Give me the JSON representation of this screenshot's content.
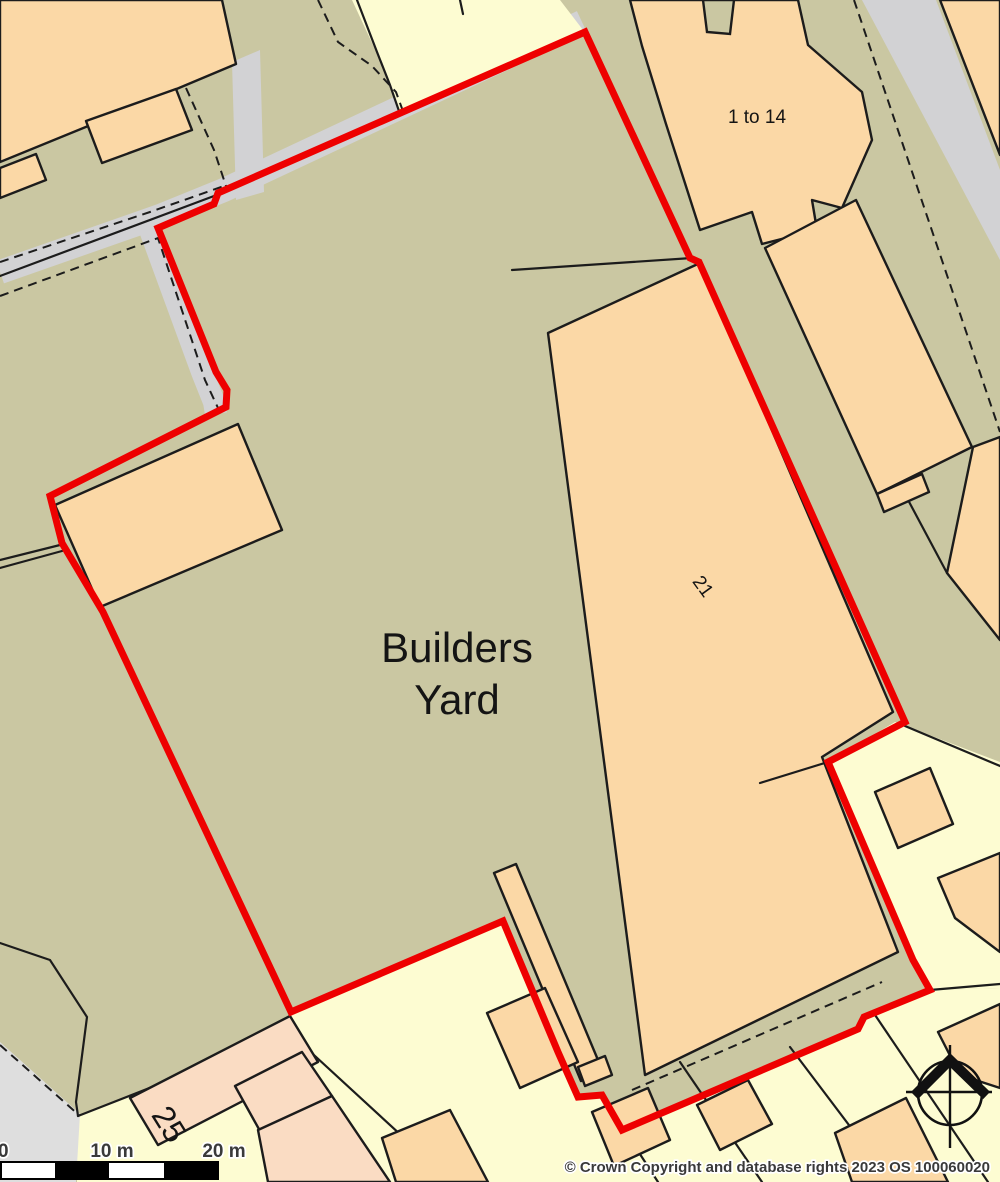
{
  "map": {
    "labels": {
      "yard_line1": "Builders",
      "yard_line2": "Yard",
      "building_1_to_14": "1 to 14",
      "building_21": "21",
      "building_25": "25"
    },
    "scale_bar": {
      "tick_0": "0",
      "tick_10": "10 m",
      "tick_20": "20 m"
    },
    "copyright": "© Crown Copyright and database rights 2023 OS 100060020",
    "icons": {
      "north_arrow": "compass-north-arrow"
    },
    "colors": {
      "boundary_red": "#ee0000",
      "building_peach": "#fbd8a6",
      "building_pink": "#fadcc3",
      "land_khaki": "#cac7a2",
      "parcel_yellow": "#fdfcd2",
      "road_gray": "#d2d2d4",
      "road_gray_light": "#dedede",
      "line_black": "#1c1c1c"
    }
  }
}
